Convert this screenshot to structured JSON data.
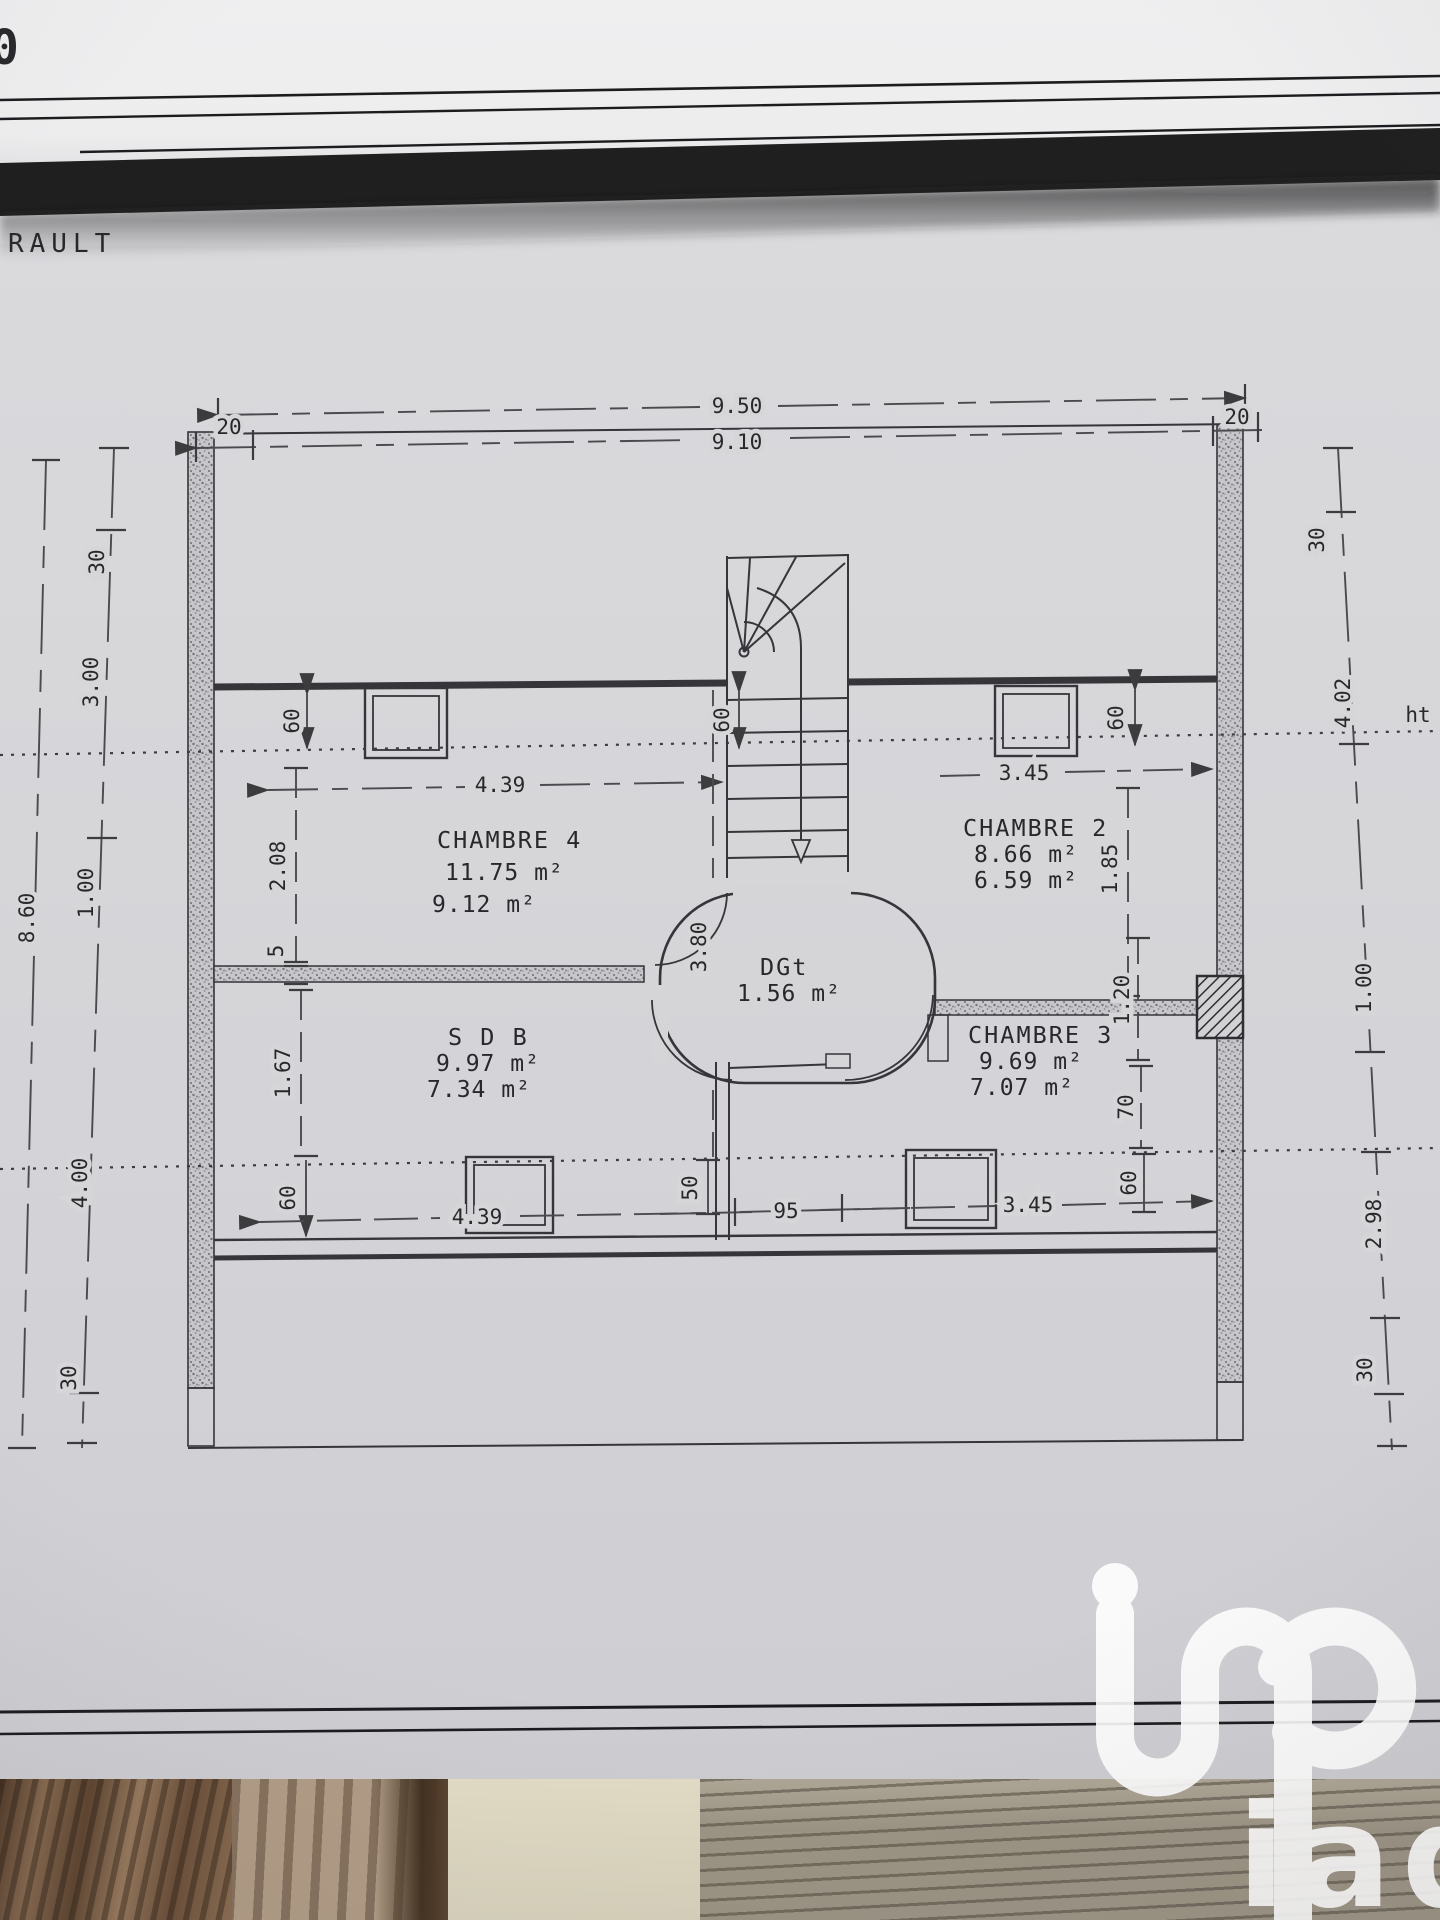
{
  "page": {
    "header_fragment": "RAULT",
    "corner_fragment": "0"
  },
  "watermark": {
    "brand": "iad"
  },
  "plan": {
    "rooms": {
      "chambre4": {
        "name": "CHAMBRE 4",
        "area_total": "11.75 m²",
        "area_hab": "9.12 m²"
      },
      "chambre2": {
        "name": "CHAMBRE 2",
        "area_total": "8.66 m²",
        "area_hab": "6.59 m²"
      },
      "chambre3": {
        "name": "CHAMBRE 3",
        "area_total": "9.69 m²",
        "area_hab": "7.07 m²"
      },
      "sdb": {
        "name": "S D B",
        "area_total": "9.97 m²",
        "area_hab": "7.34 m²"
      },
      "degagement": {
        "name": "DGt",
        "area_total": "1.56 m²"
      }
    },
    "dims": {
      "top_overall": "9.50",
      "top_wall_left": "20",
      "top_inner": "9.10",
      "top_wall_right": "20",
      "left_outer_total": "8.60",
      "left_wall_top": "30",
      "left_upper": "3.00",
      "left_mid": "1.00",
      "left_lower": "4.00",
      "left_wall_bottom": "30",
      "right_wall_top": "30",
      "right_upper": "4.02",
      "height_line": "ht",
      "right_mid": "1.00",
      "right_lower": "2.98",
      "right_wall_bottom": "30",
      "ch4_width": "4.39",
      "ch2_width": "3.45",
      "ch4_window_offset": "60",
      "stair_offset": "60",
      "ch2_window_offset": "60",
      "ch4_depth": "2.08",
      "partition_thickness": "5",
      "ch2_depth": "1.85",
      "stair_depth": "3.80",
      "sdb_depth": "1.67",
      "sdb_window_offset": "60",
      "door_width": "1.20",
      "right_70": "70",
      "right_60": "60",
      "under_stair_50": "50",
      "passage_95": "95",
      "sdb_width": "4.39",
      "ch3_width": "3.45"
    }
  }
}
